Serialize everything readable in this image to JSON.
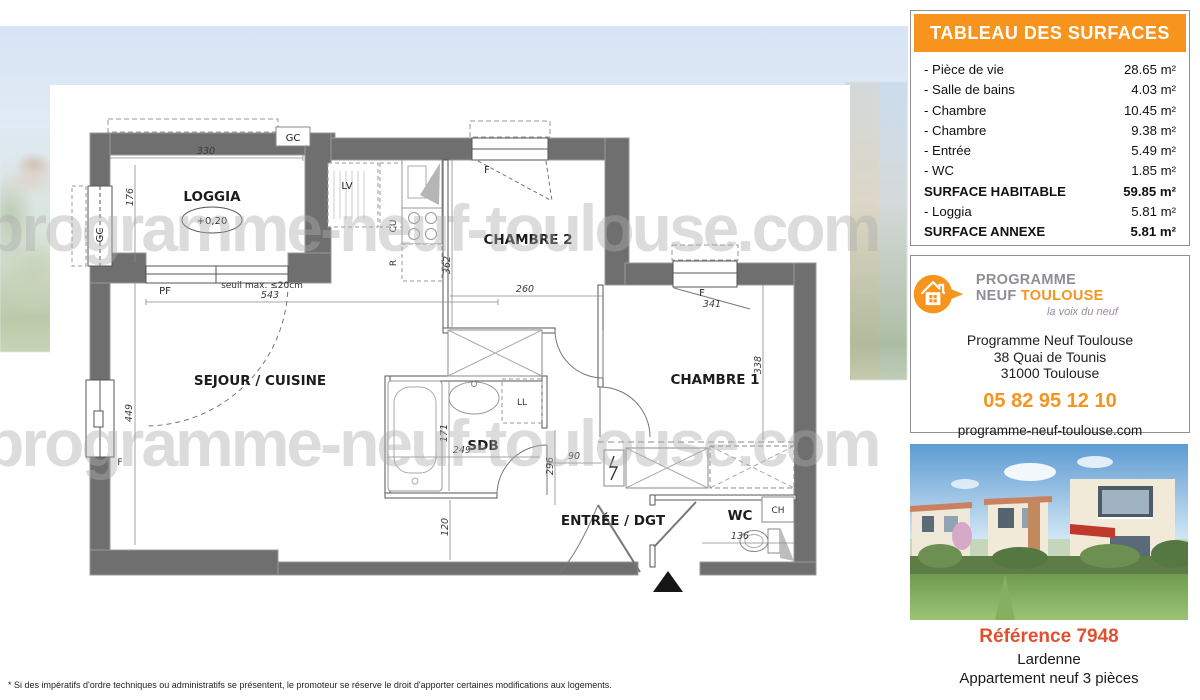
{
  "surfaces": {
    "title": "TABLEAU DES SURFACES",
    "rows": [
      {
        "label": "- Pièce de vie",
        "value": "28.65 m²"
      },
      {
        "label": "- Salle de bains",
        "value": "4.03 m²"
      },
      {
        "label": "- Chambre",
        "value": "10.45 m²"
      },
      {
        "label": "- Chambre",
        "value": "9.38 m²"
      },
      {
        "label": "- Entrée",
        "value": "5.49 m²"
      },
      {
        "label": "- WC",
        "value": "1.85 m²"
      },
      {
        "label": "SURFACE HABITABLE",
        "value": "59.85 m²"
      },
      {
        "label": "- Loggia",
        "value": "5.81 m²"
      },
      {
        "label": "SURFACE ANNEXE",
        "value": "5.81 m²"
      }
    ]
  },
  "agency": {
    "brand_gray": "PROGRAMME NEUF",
    "brand_orange": "TOULOUSE",
    "tagline": "la voix du neuf",
    "name": "Programme Neuf Toulouse",
    "address_line1": "38 Quai de Tounis",
    "address_line2": "31000 Toulouse",
    "phone": "05 82 95 12 10",
    "website": "programme-neuf-toulouse.com"
  },
  "listing": {
    "reference": "Référence 7948",
    "location": "Lardenne",
    "type": "Appartement neuf 3 pièces"
  },
  "watermark": "programme-neuf-toulouse.com",
  "disclaimer": "* Si des impératifs d'ordre techniques ou administratifs se présentent, le promoteur se réserve le droit d'apporter certaines modifications aux logements.",
  "plan": {
    "rooms": {
      "loggia": "LOGGIA",
      "loggia_level": "+0,20",
      "sejour": "SEJOUR / CUISINE",
      "chambre2": "CHAMBRE 2",
      "chambre1": "CHAMBRE 1",
      "sdb": "SDB",
      "entree": "ENTRÉE / DGT",
      "wc": "WC"
    },
    "fixtures": {
      "lv": "LV",
      "cu": "CU",
      "r": "R",
      "ll": "LL",
      "ch": "CH"
    },
    "openings": {
      "gc": "GC",
      "pf": "PF",
      "f": "F",
      "seuil": "seuil max. ≤20cm"
    },
    "dims": {
      "d330": "330",
      "d176": "176",
      "d543": "543",
      "d449": "449",
      "d362": "362",
      "d260": "260",
      "d341": "341",
      "d338": "338",
      "d249": "249",
      "d171": "171",
      "d296": "296",
      "d90": "90",
      "d120": "120",
      "d136": "136"
    },
    "colors": {
      "wall": "#6f6f6f",
      "accent": "#f7941e",
      "reference": "#e2512f"
    }
  }
}
